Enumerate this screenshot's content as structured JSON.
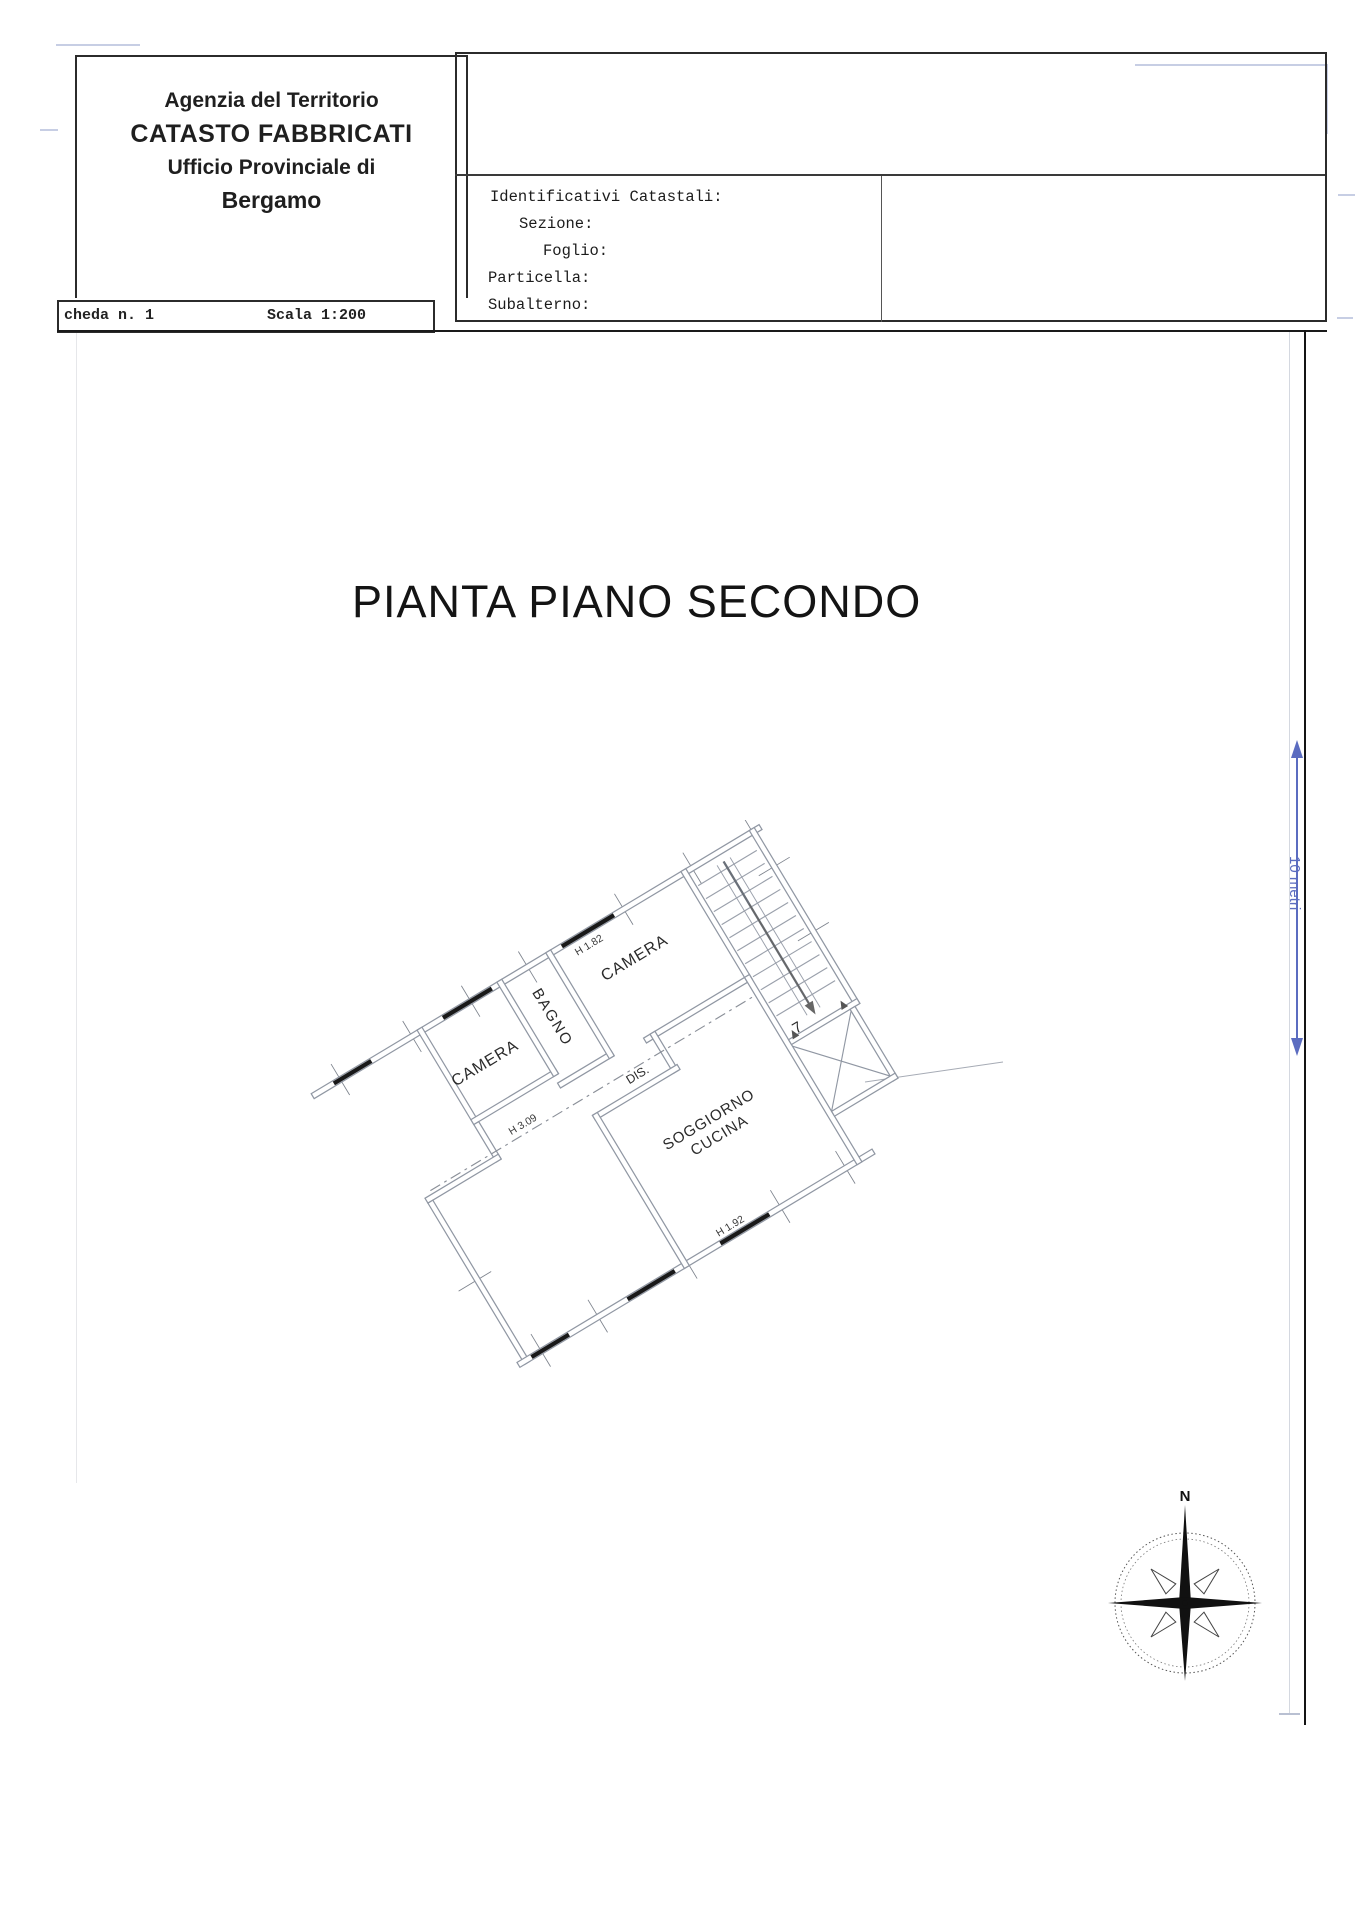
{
  "header_box": {
    "line1": "Agenzia del Territorio",
    "line2": "CATASTO FABBRICATI",
    "line3": "Ufficio Provinciale di",
    "line4": "Bergamo"
  },
  "sheet_strip": {
    "sheet_label": "cheda n. 1",
    "scale_label": "Scala 1:200"
  },
  "catastal_box": {
    "title": "Identificativi Catastali:",
    "sezione_label": "Sezione:",
    "foglio_label": "Foglio:",
    "particella_label": "Particella:",
    "subalterno_label": "Subalterno:",
    "sezione_value": "",
    "foglio_value": "",
    "particella_value": "",
    "subalterno_value": ""
  },
  "drawing": {
    "title": "PIANTA PIANO SECONDO",
    "rooms": {
      "camera_left": "CAMERA",
      "bagno": "BAGNO",
      "camera_right": "CAMERA",
      "dis": "DIS.",
      "soggiorno_line1": "SOGGIORNO",
      "soggiorno_line2": "CUCINA"
    },
    "height_labels": {
      "camera": "H 1.82",
      "middle": "H 3.09",
      "soggiorno": "H 1.92"
    },
    "stair_number": "7",
    "scale_bar_label": "10 metri",
    "compass_north": "N"
  },
  "colors": {
    "frame": "#1a1a1a",
    "plan_line": "#9097a3",
    "window_fill": "#191919",
    "scale_bar_blue": "#5b6cc0",
    "text": "#1a1a1a",
    "artifact_blue": "#c7cee4"
  }
}
